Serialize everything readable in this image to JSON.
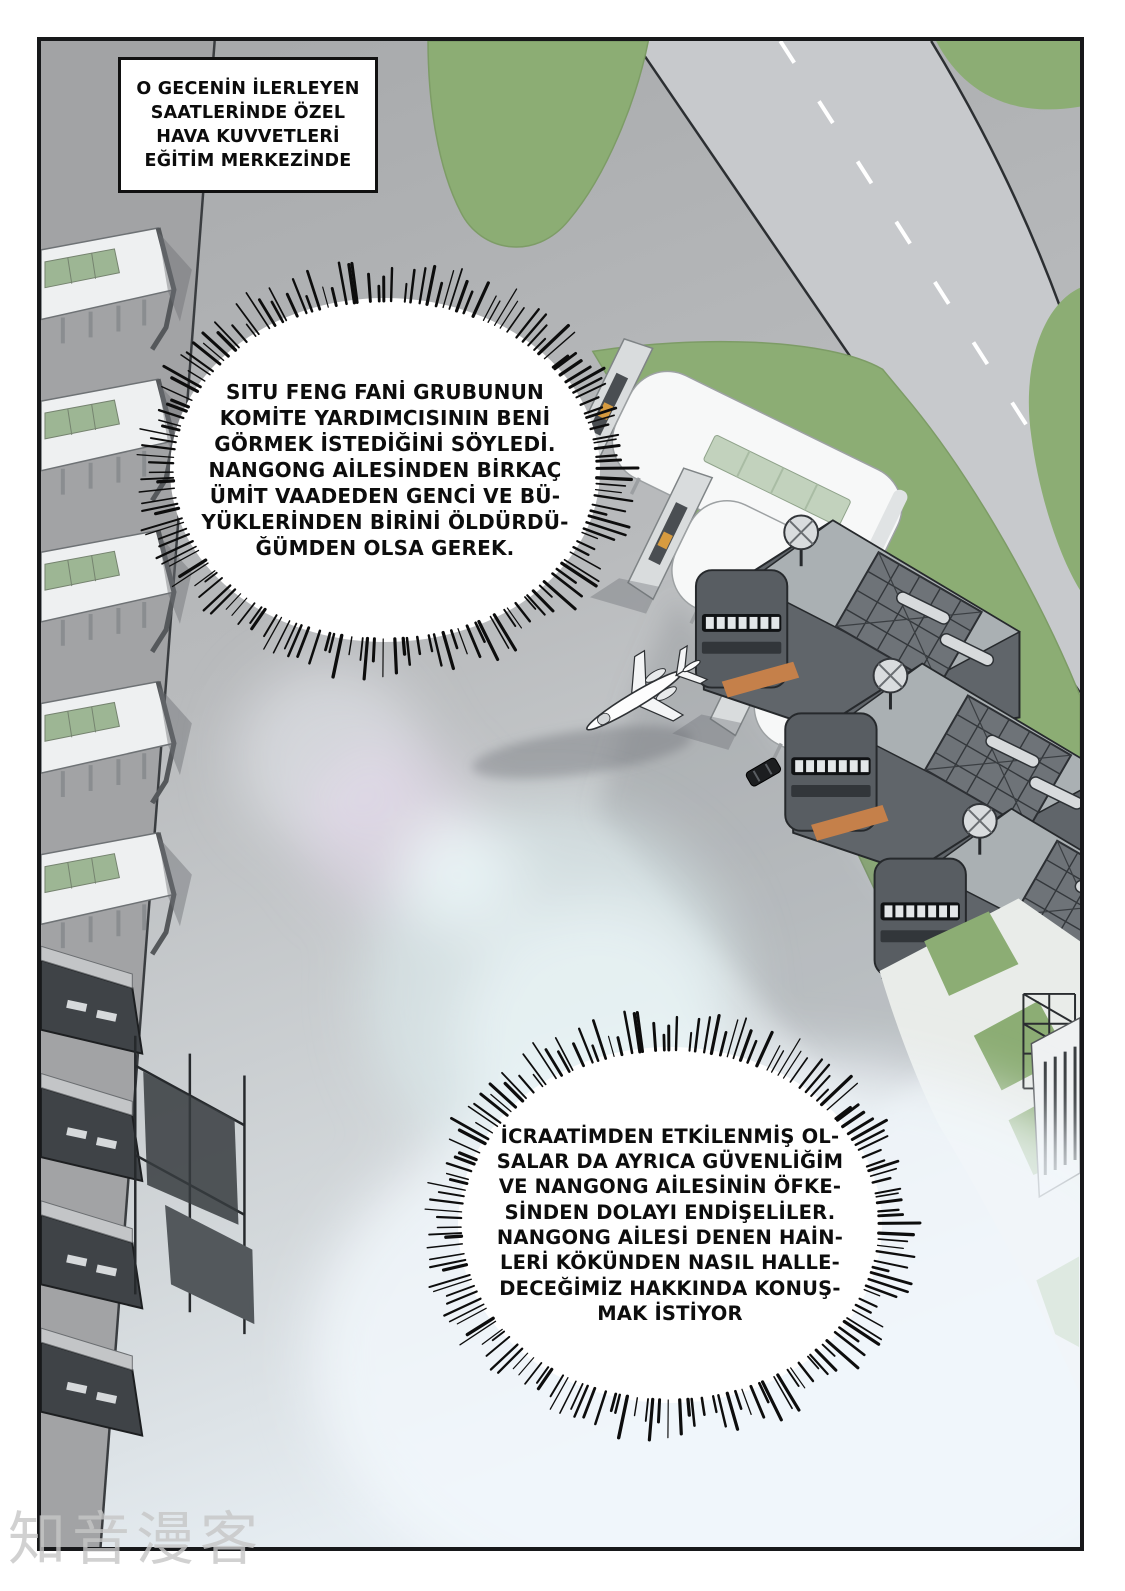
{
  "narration_box": {
    "text": "O GECENİN İLERLEYEN\nSAATLERİNDE ÖZEL\nHAVA KUVVETLERİ\nEĞİTİM MERKEZİNDE"
  },
  "speech_bubbles": [
    {
      "id": "bubble-1",
      "text": "SITU FENG FANİ GRUBUNUN\nKOMİTE YARDIMCISININ BENİ\nGÖRMEK İSTEDİĞİNİ SÖYLEDİ.\nNANGONG AİLESİNDEN BİRKAÇ\nÜMİT VAADEDEN GENCİ VE BÜ-\nYÜKLERİNDEN BİRİNİ ÖLDÜRDÜ-\nĞÜMDEN OLSA GEREK."
    },
    {
      "id": "bubble-2",
      "text": "İCRAATİMDEN ETKİLENMİŞ OL-\nSALAR DA AYRICA GÜVENLİĞİM\nVE NANGONG AİLESİNİN ÖFKE-\nSİNDEN DOLAYI ENDİŞELİLER.\nNANGONG AİLESİ DENEN HAİN-\nLERİ KÖKÜNDEN NASIL HALLE-\nDECEĞİMİZ HAKKINDA KONUŞ-\nMAK İSTİYOR"
    }
  ],
  "watermark": {
    "text": "知音漫客"
  },
  "palette": {
    "grass_green": "#8cad74",
    "tarmac_gray": "#b4b6b8",
    "runway_gray": "#c7c9cc",
    "hangar_white": "#f7f8f8",
    "skylight_green": "#c2d2bd",
    "building_dark": "#60656a",
    "accent_orange": "#c5804a",
    "panel_border": "#17181a"
  }
}
